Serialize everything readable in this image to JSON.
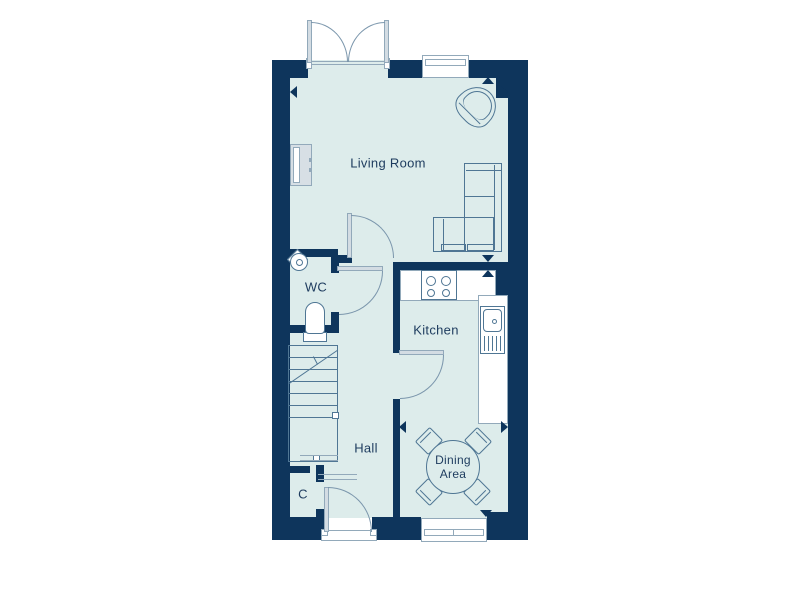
{
  "plan": {
    "type": "floorplan",
    "rooms": [
      {
        "id": "living-room",
        "label": "Living Room"
      },
      {
        "id": "wc",
        "label": "WC"
      },
      {
        "id": "kitchen",
        "label": "Kitchen"
      },
      {
        "id": "hall",
        "label": "Hall"
      },
      {
        "id": "dining-area",
        "label": "Dining Area"
      },
      {
        "id": "cupboard",
        "label": "C"
      }
    ],
    "fixtures": [
      "french-doors",
      "window",
      "armchair",
      "corner-sofa",
      "radiator",
      "corner-basin",
      "toilet",
      "staircase",
      "hob",
      "sink-drainer",
      "worktop",
      "dining-table",
      "dining-chair",
      "front-door",
      "internal-door",
      "dimension-marker"
    ],
    "colors": {
      "wall": "#0e355c",
      "floor": "#ddeceb",
      "line": "#4f7694",
      "frame": "#92a9ba",
      "leaf": "#d3dce3",
      "arc": "#7b96ac",
      "text": "#1d3b5e",
      "bg": "#ffffff"
    }
  }
}
